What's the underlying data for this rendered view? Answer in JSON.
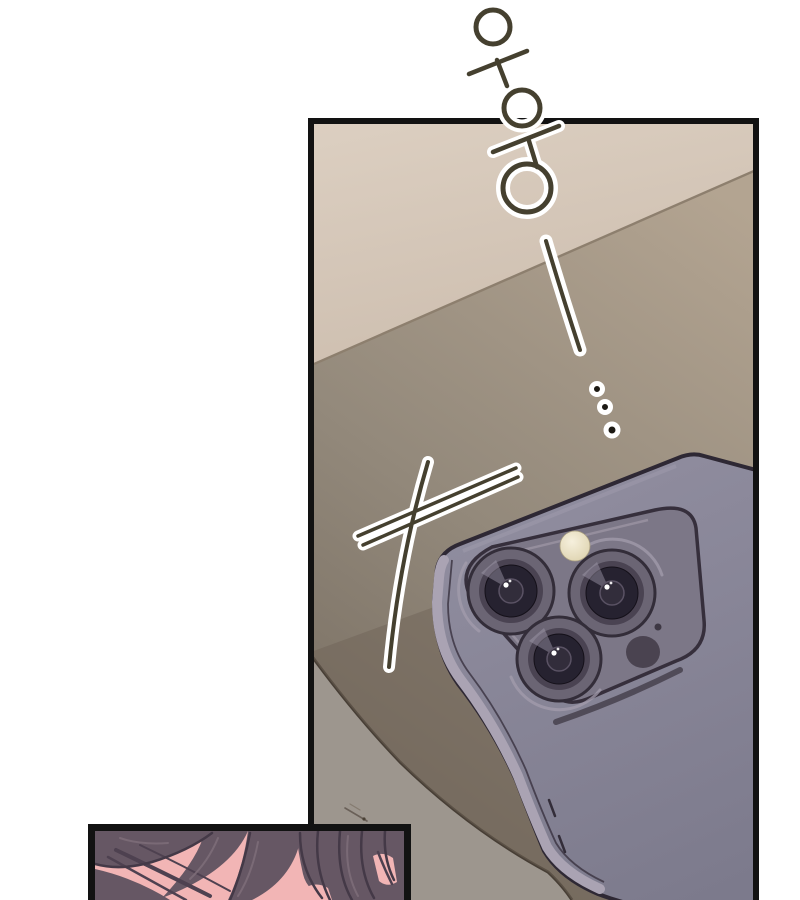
{
  "page": {
    "type": "webtoon comic page",
    "background": "#ffffff"
  },
  "sfx": {
    "vibration_text": "우웅",
    "long_dash": "ー",
    "trailing_dots": "…"
  },
  "panels": {
    "main": {
      "content": "smartphone with triple rear camera lying face-down on a desk",
      "border_color": "#121212"
    },
    "bottom": {
      "content": "close-up of dark hair strands over a forehead",
      "border_color": "#121212"
    }
  },
  "colors": {
    "page": "#ffffff",
    "border": "#121212",
    "halo": "#ffffff",
    "ink": "#45402f",
    "wall": "#d9cbbd",
    "wall_low": "#cdbeaf",
    "seam": "#8d7f6e",
    "desk": "#b3a491",
    "desk_dark": "#786e62",
    "floor": "#9d968e",
    "floor_line": "#473e35",
    "shadow_band": "#6f6457",
    "phone_body": "#918ea0",
    "phone_body_low": "#7c7a8c",
    "phone_rail": "#aaa3b3",
    "phone_outline": "#2e2834",
    "phone_plate": "#7c7787",
    "lens_outer": "#6b6574",
    "lens_mid": "#4a4352",
    "lens_glass": "#262230",
    "lens_highlight": "#a49daf",
    "flash": "#ece4ca",
    "lidar": "#4a4350",
    "skin": "#f2b5b5",
    "hair": "#665764",
    "hair_dark": "#443947",
    "hair_highlight": "#7d6d78"
  }
}
